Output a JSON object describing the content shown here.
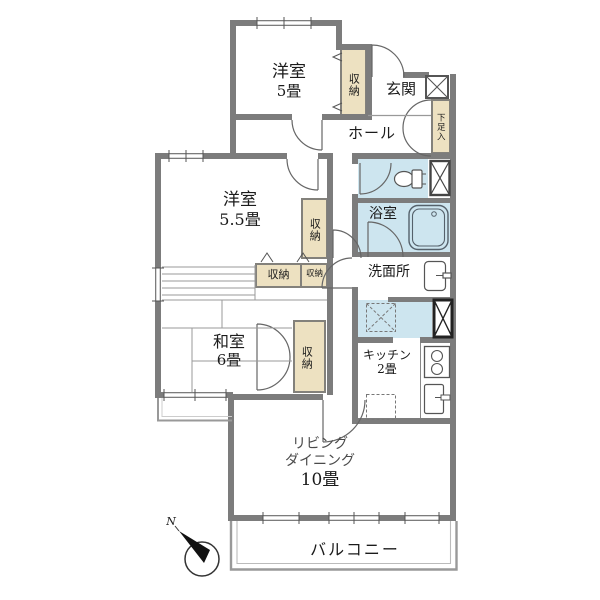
{
  "rooms": {
    "yoshitsu5": {
      "name": "洋室",
      "size": "5畳"
    },
    "yoshitsu55": {
      "name": "洋室",
      "size": "5.5畳"
    },
    "washitsu": {
      "name": "和室",
      "size": "6畳"
    },
    "genkan": {
      "label": "玄関"
    },
    "hall": {
      "label": "ホール"
    },
    "bath": {
      "label": "浴室"
    },
    "senmenjo": {
      "label": "洗面所"
    },
    "kitchen": {
      "name": "キッチン",
      "size": "2畳"
    },
    "living": {
      "line1": "リビング",
      "line2": "ダイニング",
      "size": "10畳"
    },
    "balcony": {
      "label": "バルコニー"
    }
  },
  "storage": {
    "closet": "収納",
    "shoe_cabinet": "下足入"
  },
  "compass": {
    "label": "N"
  },
  "icons": {
    "toilet-icon": "toilet bowl with tank",
    "bathtub-icon": "bathtub",
    "washbasin-icon": "wash basin with tap",
    "stove-icon": "two burner stove",
    "kitchen-sink-icon": "sink with tap",
    "washer-space-icon": "dashed square with X",
    "fridge-space-icon": "dashed square",
    "pipe-shaft-icon": "box with X cross",
    "compass-icon": "north needle in circle"
  },
  "colors": {
    "wall": "#7c7c7c",
    "storage": "#ede1c1",
    "wet": "#cde5ef",
    "line": "#666666",
    "label": "#1b1b1b"
  }
}
